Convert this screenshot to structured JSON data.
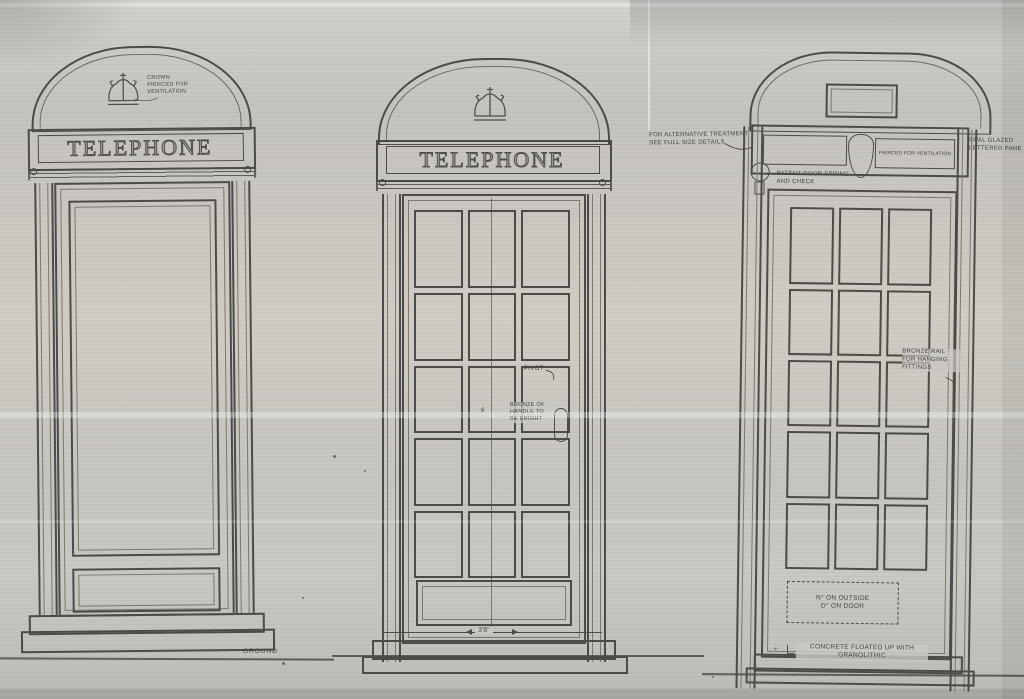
{
  "palette": {
    "paper": "#cac8c4",
    "ink": "#4d4b47",
    "ink_light": "#7b786f"
  },
  "kiosks": {
    "left": {
      "sign": "TELEPHONE",
      "crown_note": "CROWN\nPIERCED FOR\nVENTILATION",
      "ground_label": "GROUND"
    },
    "middle": {
      "sign": "TELEPHONE",
      "pivot_note": "PIVOT",
      "handle_note": "BRONZE OF\nHANDLE TO\nBE BRIGHT",
      "center_dim": "6",
      "width_dim": "3'6\""
    },
    "right": {
      "treatment_note": "FOR ALTERNATIVE TREATMENT\nSEE FULL SIZE DETAILS",
      "vent_note": "PIERCED FOR VENTILATION",
      "pane_note": "OPAL GLAZED\nLETTERED PANE",
      "spring_note": "PATENT DOOR SPRING\nAND CHECK",
      "rail_note": "BRONZE RAIL\nFOR HANGING\nFITTINGS",
      "number_note": "N° ON OUTSIDE\nD° ON DOOR",
      "concrete_note": "CONCRETE FLOATED UP WITH\nGRANOLITHIC"
    }
  }
}
